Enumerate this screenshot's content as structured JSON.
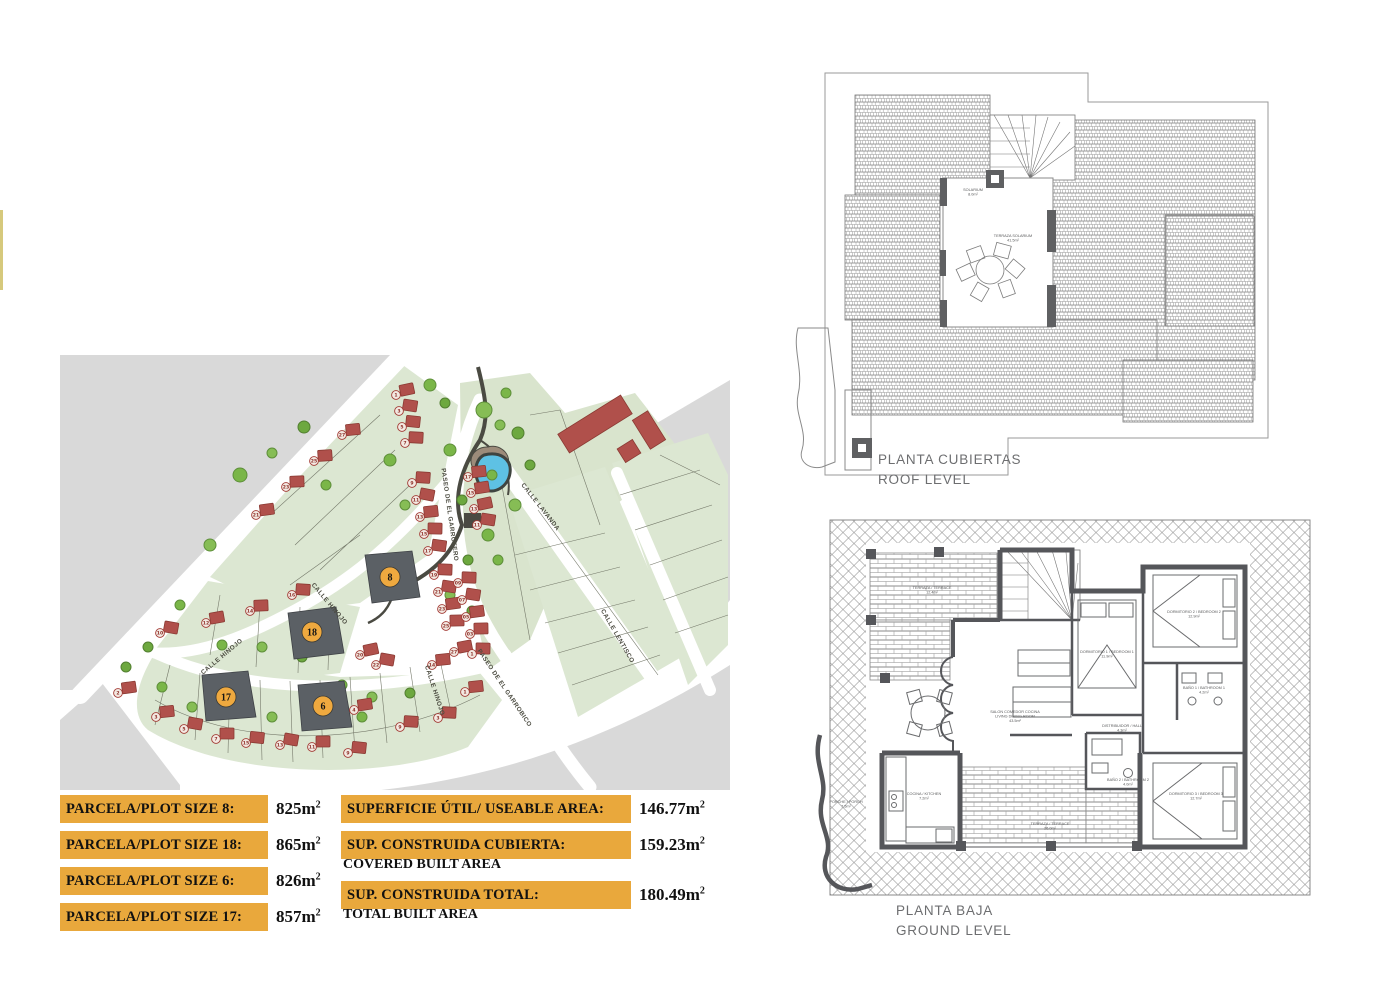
{
  "page": {
    "background": "#ffffff",
    "edge_strip_color": "#d6c97c"
  },
  "tables": {
    "plots": [
      {
        "label": "PARCELA/PLOT SIZE 8:",
        "value": "825",
        "unit": "m",
        "sup": "2"
      },
      {
        "label": "PARCELA/PLOT SIZE 18:",
        "value": "865",
        "unit": "m",
        "sup": "2"
      },
      {
        "label": "PARCELA/PLOT SIZE 6:",
        "value": "826",
        "unit": "m",
        "sup": "2"
      },
      {
        "label": "PARCELA/PLOT SIZE 17:",
        "value": "857",
        "unit": "m",
        "sup": "2"
      }
    ],
    "areas": [
      {
        "label": "SUPERFICIE ÚTIL/ USEABLE AREA:",
        "sublabel": "",
        "value": "146.77",
        "unit": "m",
        "sup": "2"
      },
      {
        "label": "SUP. CONSTRUIDA CUBIERTA:",
        "sublabel": "COVERED BUILT AREA",
        "value": "159.23",
        "unit": "m",
        "sup": "2"
      },
      {
        "label": "SUP. CONSTRUIDA TOTAL:",
        "sublabel": "TOTAL BUILT AREA",
        "value": "180.49",
        "unit": "m",
        "sup": "2"
      }
    ]
  },
  "site_plan": {
    "colors": {
      "terrain": "#d9d9d9",
      "block": "#dce7d2",
      "road": "#ffffff",
      "house": "#b0504b",
      "tree": "#7ab648",
      "highlight_plot": "#5b6065",
      "highlight_circle": "#efa93f",
      "pond": "#5ec1e4"
    },
    "street_labels": [
      {
        "text": "PASEO DE EL GARROFERO",
        "x": 388,
        "y": 160,
        "angle": 82
      },
      {
        "text": "CALLE LAVANDA",
        "x": 479,
        "y": 153,
        "angle": 52
      },
      {
        "text": "CALLE LENTISCO",
        "x": 556,
        "y": 282,
        "angle": 60
      },
      {
        "text": "CALLE HINOJO",
        "x": 268,
        "y": 250,
        "angle": 50
      },
      {
        "text": "CALLE HINOJO",
        "x": 163,
        "y": 303,
        "angle": -40
      },
      {
        "text": "CALLE HINOJO",
        "x": 373,
        "y": 336,
        "angle": 72
      },
      {
        "text": "PASEO DE EL GARROBICO",
        "x": 443,
        "y": 334,
        "angle": 56
      }
    ],
    "highlight_plots": [
      {
        "number": "8",
        "x": 330,
        "y": 222
      },
      {
        "number": "18",
        "x": 252,
        "y": 277
      },
      {
        "number": "6",
        "x": 263,
        "y": 351
      },
      {
        "number": "17",
        "x": 166,
        "y": 342
      }
    ],
    "house_numbers": [
      {
        "n": "1",
        "x": 336,
        "y": 40
      },
      {
        "n": "3",
        "x": 339,
        "y": 56
      },
      {
        "n": "5",
        "x": 342,
        "y": 72
      },
      {
        "n": "7",
        "x": 345,
        "y": 88
      },
      {
        "n": "9",
        "x": 352,
        "y": 128
      },
      {
        "n": "11",
        "x": 356,
        "y": 145
      },
      {
        "n": "13",
        "x": 360,
        "y": 162
      },
      {
        "n": "15",
        "x": 364,
        "y": 179
      },
      {
        "n": "17",
        "x": 368,
        "y": 196
      },
      {
        "n": "19",
        "x": 374,
        "y": 220
      },
      {
        "n": "21",
        "x": 378,
        "y": 237
      },
      {
        "n": "23",
        "x": 382,
        "y": 254
      },
      {
        "n": "25",
        "x": 386,
        "y": 271
      },
      {
        "n": "17",
        "x": 408,
        "y": 122
      },
      {
        "n": "15",
        "x": 411,
        "y": 138
      },
      {
        "n": "13",
        "x": 414,
        "y": 154
      },
      {
        "n": "11",
        "x": 417,
        "y": 170
      },
      {
        "n": "09",
        "x": 398,
        "y": 228
      },
      {
        "n": "07",
        "x": 402,
        "y": 245
      },
      {
        "n": "05",
        "x": 406,
        "y": 262
      },
      {
        "n": "03",
        "x": 410,
        "y": 279
      },
      {
        "n": "27",
        "x": 394,
        "y": 297
      },
      {
        "n": "1",
        "x": 412,
        "y": 299
      },
      {
        "n": "21",
        "x": 196,
        "y": 160
      },
      {
        "n": "23",
        "x": 226,
        "y": 132
      },
      {
        "n": "25",
        "x": 254,
        "y": 106
      },
      {
        "n": "27",
        "x": 282,
        "y": 80
      },
      {
        "n": "10",
        "x": 100,
        "y": 278
      },
      {
        "n": "12",
        "x": 146,
        "y": 268
      },
      {
        "n": "14",
        "x": 190,
        "y": 256
      },
      {
        "n": "16",
        "x": 232,
        "y": 240
      },
      {
        "n": "20",
        "x": 300,
        "y": 300
      },
      {
        "n": "22",
        "x": 316,
        "y": 310
      },
      {
        "n": "4",
        "x": 294,
        "y": 355
      },
      {
        "n": "2",
        "x": 58,
        "y": 338
      },
      {
        "n": "3",
        "x": 96,
        "y": 362
      },
      {
        "n": "5",
        "x": 124,
        "y": 374
      },
      {
        "n": "7",
        "x": 156,
        "y": 384
      },
      {
        "n": "9",
        "x": 288,
        "y": 398
      },
      {
        "n": "11",
        "x": 252,
        "y": 392
      },
      {
        "n": "13",
        "x": 220,
        "y": 390
      },
      {
        "n": "15",
        "x": 186,
        "y": 388
      },
      {
        "n": "1",
        "x": 405,
        "y": 337
      },
      {
        "n": "3",
        "x": 378,
        "y": 363
      },
      {
        "n": "14",
        "x": 372,
        "y": 310
      },
      {
        "n": "9",
        "x": 340,
        "y": 372
      }
    ]
  },
  "roof_plan": {
    "caption_line1": "PLANTA CUBIERTAS",
    "caption_line2": "ROOF LEVEL",
    "labels": [
      {
        "x": 183,
        "y": 131,
        "lines": [
          "SOLARIUM",
          "8.0m²"
        ]
      },
      {
        "x": 223,
        "y": 177,
        "lines": [
          "TERRAZA SOLARIUM",
          "41.5m²"
        ]
      }
    ]
  },
  "ground_plan": {
    "caption_line1": "PLANTA BAJA",
    "caption_line2": "GROUND LEVEL",
    "labels": [
      {
        "x": 122,
        "y": 84,
        "lines": [
          "TERRAZA / TERRACE",
          "12.4m²"
        ]
      },
      {
        "x": 205,
        "y": 208,
        "lines": [
          "SALON COMEDOR COCINA",
          "LIVING DINING ROOM",
          "43.5m²"
        ]
      },
      {
        "x": 297,
        "y": 148,
        "lines": [
          "DORMITORIO 1 / BEDROOM 1",
          "11.9m²"
        ]
      },
      {
        "x": 384,
        "y": 108,
        "lines": [
          "DORMITORIO 2 / BEDROOM 2",
          "12.9m²"
        ]
      },
      {
        "x": 394,
        "y": 184,
        "lines": [
          "BAÑO 1 / BATHROOM 1",
          "4.2m²"
        ]
      },
      {
        "x": 312,
        "y": 222,
        "lines": [
          "DISTRIBUIDOR / HALL",
          "4.3m²"
        ]
      },
      {
        "x": 318,
        "y": 276,
        "lines": [
          "BAÑO 2 / BATHROOM 2",
          "4.0m²"
        ]
      },
      {
        "x": 386,
        "y": 290,
        "lines": [
          "DORMITORIO 3 / BEDROOM 3",
          "12.7m²"
        ]
      },
      {
        "x": 114,
        "y": 290,
        "lines": [
          "COCINA / KITCHEN",
          "7.2m²"
        ]
      },
      {
        "x": 36,
        "y": 298,
        "lines": [
          "PORCHE / PORCH",
          "7.5m²"
        ]
      },
      {
        "x": 240,
        "y": 320,
        "lines": [
          "TERRAZA / TERRACE",
          "26.0m²"
        ]
      }
    ]
  }
}
